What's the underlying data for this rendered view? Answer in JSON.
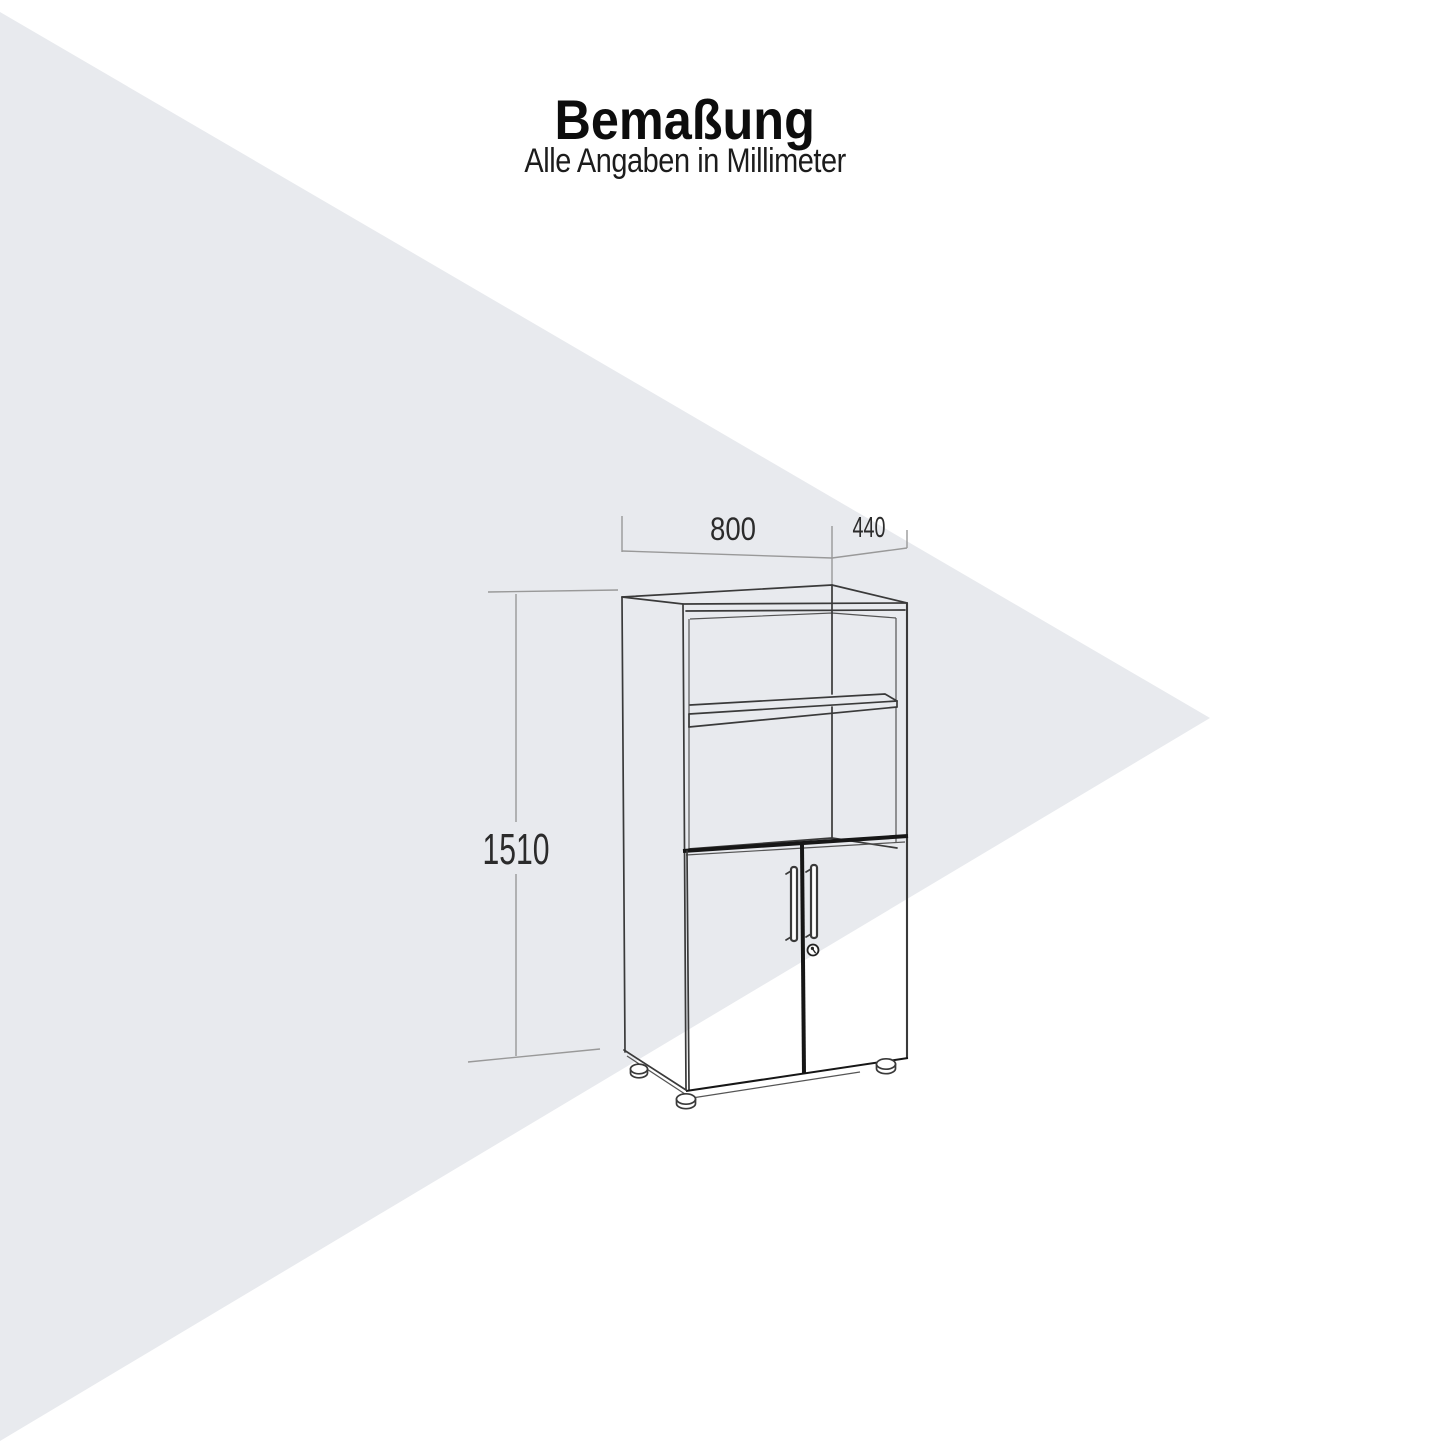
{
  "title": "Bemaßung",
  "subtitle": "Alle Angaben in Millimeter",
  "dimensions": {
    "width_mm": "800",
    "depth_mm": "440",
    "height_mm": "1510"
  },
  "colors": {
    "canvas": "#ffffff",
    "watermark_triangle": "#e8eaee",
    "drawing_line": "#3a3a3a",
    "drawing_dark_line": "#161616",
    "dimension_line": "#999999",
    "label_text": "#2b2b2b",
    "title_text": "#0d0d0d"
  }
}
